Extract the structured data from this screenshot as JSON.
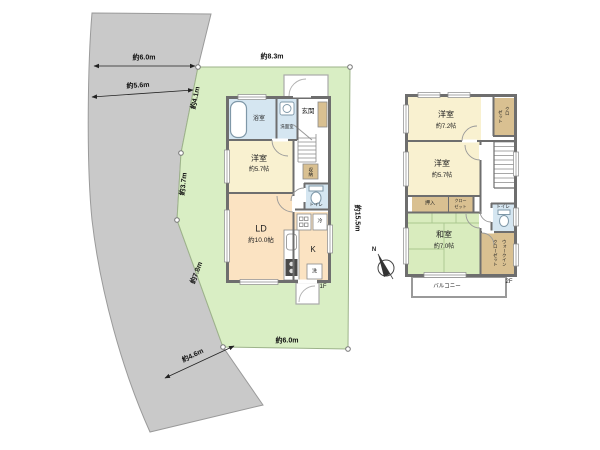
{
  "site": {
    "dimensions": {
      "top_width": "約6.0m",
      "upper_width": "約5.6m",
      "side_upper": "約4.1m",
      "side_mid": "約3.7m",
      "side_diag": "約7.8m",
      "road_width": "約4.6m",
      "bottom_width": "約6.0m",
      "lot_top": "約8.3m",
      "lot_right": "約15.5m"
    },
    "colors": {
      "land_gray": "#c9c9c9",
      "lot_green": "#d9eec4",
      "room_cream": "#f9f1d0",
      "room_peach": "#fbe3c2",
      "tatami_green": "#d9ecbe",
      "closet_tan": "#d9c091",
      "water_blue": "#d5e6f1",
      "wall_gray": "#6e6e6e"
    }
  },
  "floor1": {
    "label": "1F",
    "rooms": {
      "bath": "浴室",
      "washroom": "洗面室",
      "entrance": "玄関",
      "western_room": "洋室",
      "western_room_size": "約5.7帖",
      "storage": "収納",
      "toilet": "トイレ",
      "living_dining": "LD",
      "living_dining_size": "約10.0帖",
      "kitchen": "K",
      "fridge": "冷",
      "washer": "洗"
    }
  },
  "floor2": {
    "label": "2F",
    "rooms": {
      "western_a": "洋室",
      "western_a_size": "約7.2帖",
      "western_b": "洋室",
      "western_b_size": "約5.7帖",
      "closet_col_r": "クロ",
      "closet_col_l": "ゼット",
      "oshiire": "押入",
      "closet2_l1": "クロー",
      "closet2_l2": "ゼット",
      "japanese_room": "和室",
      "japanese_room_size": "約7.0帖",
      "toilet": "トイレ",
      "wic_col_r": "ウォークイン",
      "wic_col_l": "クローゼット",
      "balcony": "バルコニー"
    }
  },
  "compass": {
    "north": "N"
  }
}
